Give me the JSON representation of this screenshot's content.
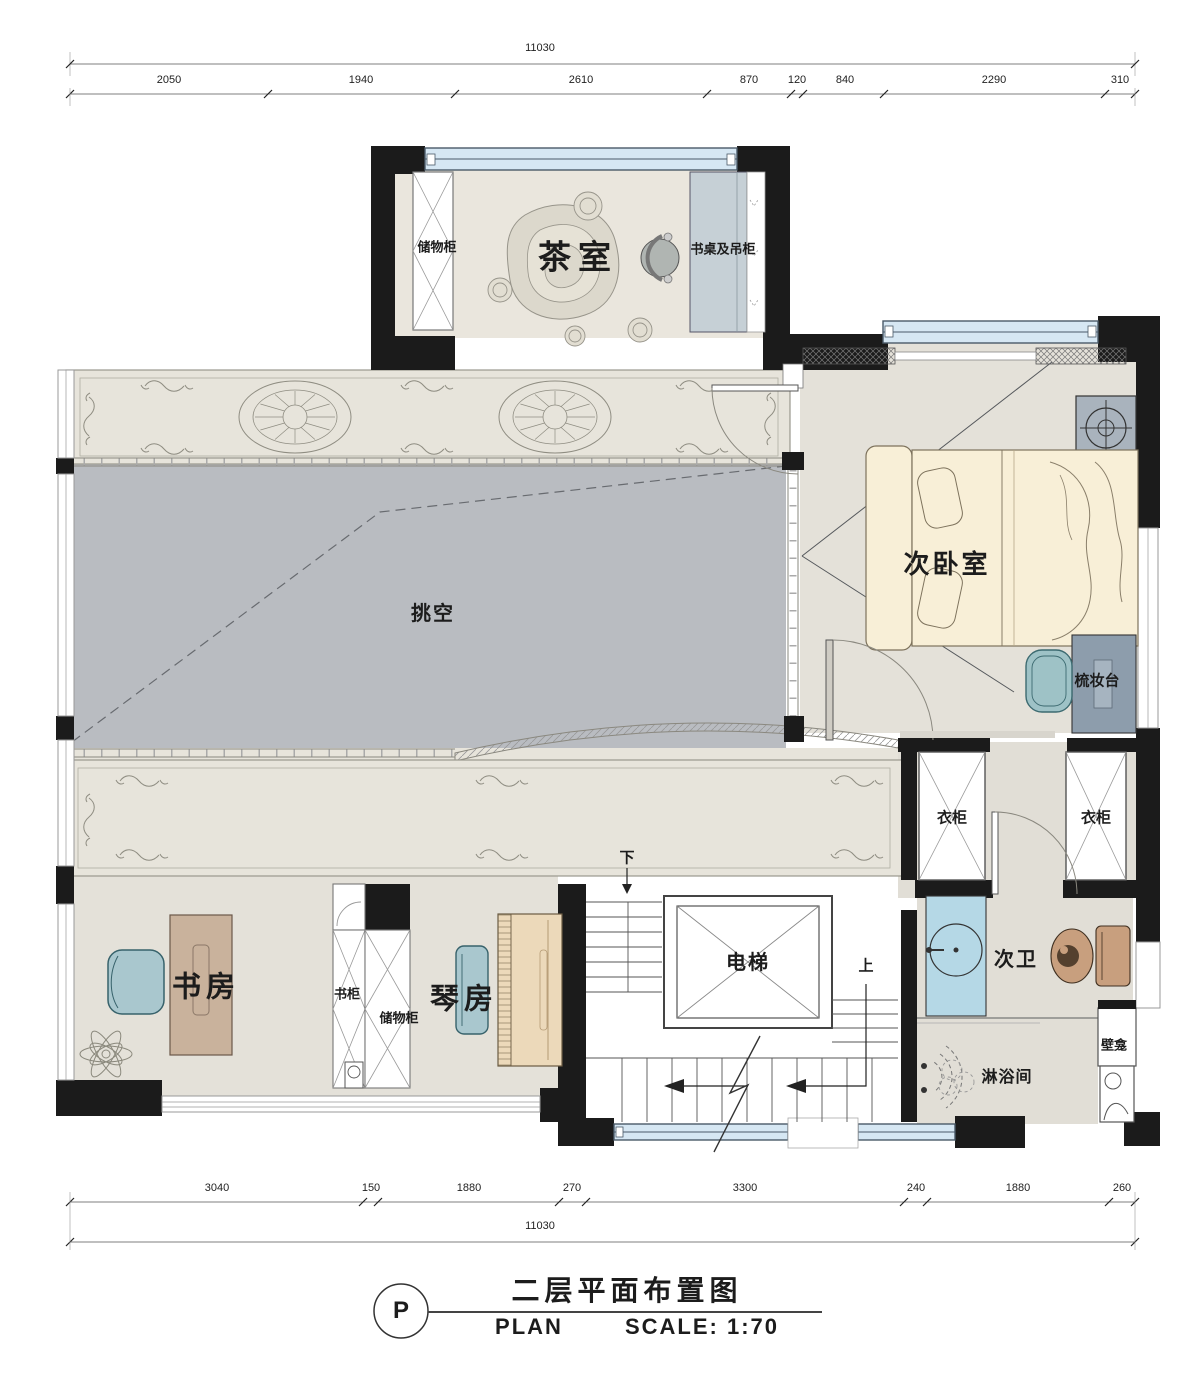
{
  "title_block": {
    "marker": "P",
    "title_cn": "二层平面布置图",
    "title_en": "PLAN",
    "scale": "SCALE: 1:70"
  },
  "dimensions": {
    "top_total": "11030",
    "top_segments": [
      "2050",
      "1940",
      "2610",
      "870",
      "120",
      "840",
      "2290",
      "310"
    ],
    "bottom_segments": [
      "3040",
      "150",
      "1880",
      "270",
      "3300",
      "240",
      "1880",
      "260"
    ],
    "bottom_total": "11030"
  },
  "rooms": {
    "tea_room": "茶室",
    "storage_top": "储物柜",
    "desk_hanging": "书桌及吊柜",
    "bedroom": "次卧室",
    "void": "挑空",
    "dresser": "梳妆台",
    "wardrobe_a": "衣柜",
    "wardrobe_b": "衣柜",
    "study": "书房",
    "bookcase": "书柜",
    "storage_study": "储物柜",
    "piano": "琴房",
    "elevator": "电梯",
    "bath": "次卫",
    "shower": "淋浴间",
    "niche": "壁龛",
    "down": "下",
    "up": "上"
  },
  "colors": {
    "wall": "#1b1b1b",
    "void_fill": "#b9bcc1",
    "window_glass": "#d6e7f3",
    "bed": "#f8efd7",
    "floor": "#e4e1d9",
    "band": "#e7e4db",
    "teal": "#a9c7ce",
    "desk_wood": "#c9b29c",
    "piano_wood": "#ecd9ba",
    "vanity_blue": "#b5d8e6",
    "toilet_tan": "#c89f7e",
    "dresser_gray": "#8d9dac"
  }
}
